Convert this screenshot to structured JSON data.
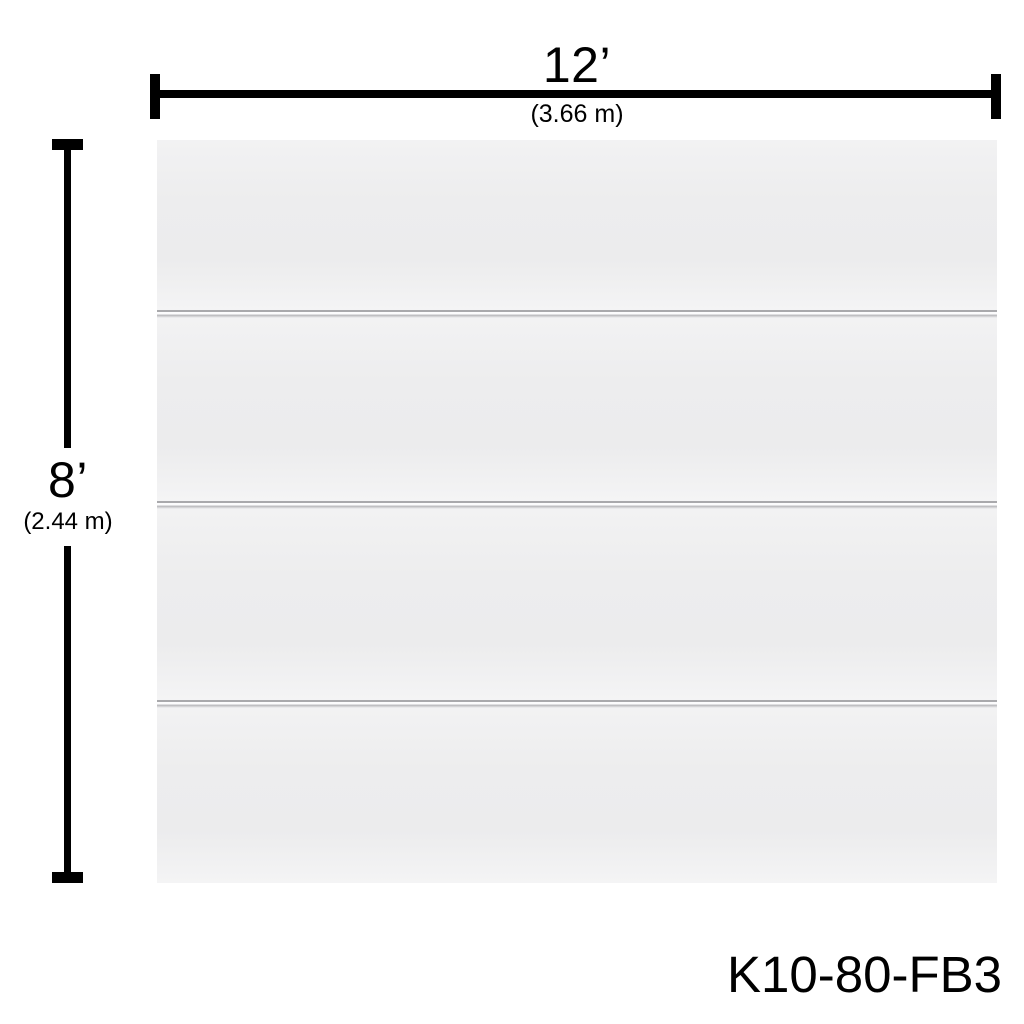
{
  "dimensions": {
    "width": {
      "imperial": "12’",
      "metric": "(3.66 m)"
    },
    "height": {
      "imperial": "8’",
      "metric": "(2.44 m)"
    }
  },
  "product_code": "K10-80-FB3",
  "panel": {
    "sections": 4,
    "grooves": 3
  },
  "colors": {
    "dimension_line": "#000000",
    "text": "#000000",
    "panel_face": "#efeff0",
    "groove": "#a9a9ac",
    "background": "#ffffff"
  }
}
